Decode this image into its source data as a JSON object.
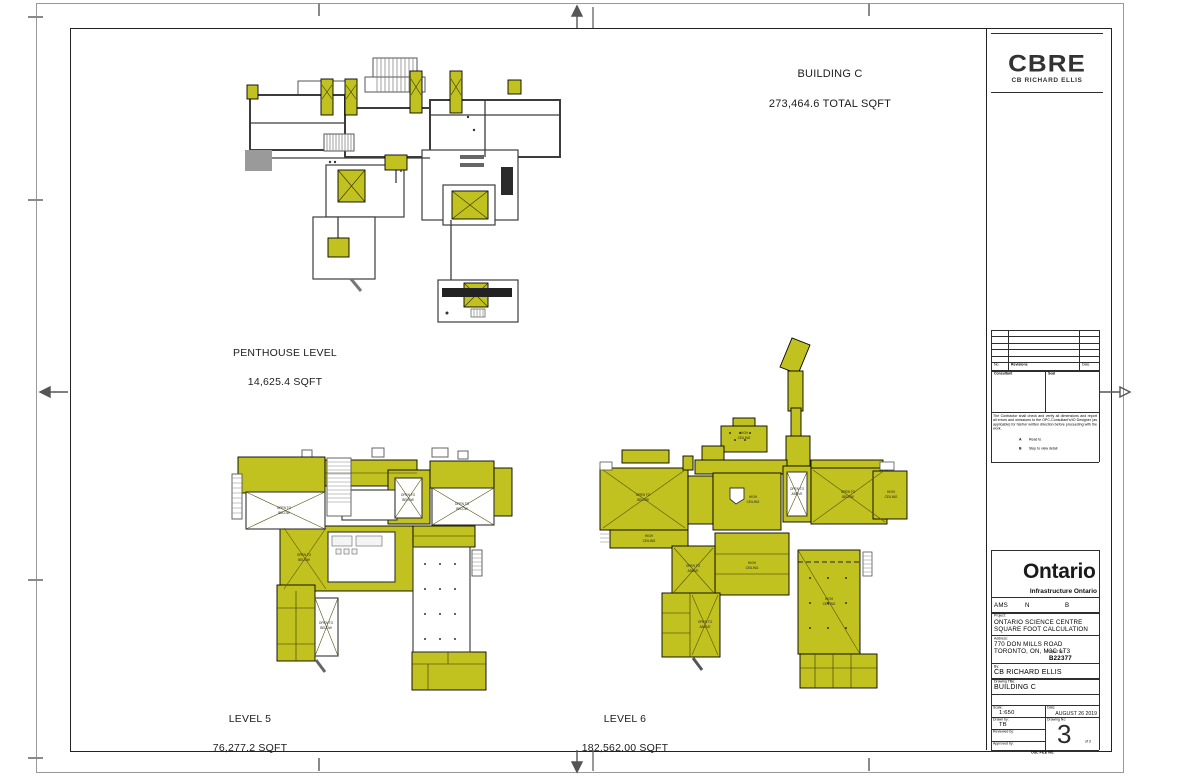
{
  "colors": {
    "plan_yellow": "#c1c11f",
    "wall": "#3c3c3c",
    "frame": "#222222"
  },
  "header": {
    "title": "BUILDING C",
    "subtitle": "273,464.6 TOTAL SQFT"
  },
  "plans": {
    "penthouse": {
      "name": "PENTHOUSE LEVEL",
      "area": "14,625.4 SQFT"
    },
    "level5": {
      "name": "LEVEL 5",
      "area": "76,277.2 SQFT"
    },
    "level6": {
      "name": "LEVEL 6",
      "area": "182,562.00 SQFT"
    },
    "annotations": {
      "open_to": "OPEN TO",
      "below": "BELOW",
      "above": "ABOVE",
      "high": "HIGH",
      "ceiling": "CEILING"
    }
  },
  "titleblock": {
    "cbre": "CBRE",
    "cbre_sub": "CB RICHARD ELLIS",
    "rev_no": "No.",
    "rev_desc": "Revisions",
    "rev_date": "Date",
    "consultant": "Consultant",
    "seal": "Seal",
    "note": "The Contractor shall check and verify all dimensions and report all errors and omissions to the OPC-Consultant's/IO Designer (as applicable) for his/her written direction before proceeding with the work.",
    "legend_a": "A",
    "legend_a_text": "Read to",
    "legend_b": "B",
    "legend_b_text": "Step to view detail",
    "ontario": "Ontario",
    "ontario_sub": "Infrastructure Ontario",
    "ams": "AMS",
    "ams_n": "N",
    "ams_b": "B",
    "project_label": "Project:",
    "project1": "ONTARIO SCIENCE CENTRE",
    "project2": "SQUARE FOOT CALCULATION",
    "address_label": "Address:",
    "address1": "770 DON MILLS ROAD",
    "address2": "TORONTO, ON, M3C 1T3",
    "project_no_label": "Project No:",
    "project_no": "B22377",
    "by_label": "By:",
    "by": "CB RICHARD ELLIS",
    "title_label": "Drawing Title:",
    "title": "BUILDING C",
    "scale_label": "Scale:",
    "scale": "1:650",
    "date_label": "Date:",
    "date": "AUGUST 26 2019",
    "drawn_label": "Drawn by:",
    "drawn": "TB",
    "reviewed_label": "Reviewed by:",
    "approved_label": "Approved by:",
    "dwg_label": "Drawing No:",
    "dwg_no": "3",
    "dwg_of": "of 3",
    "footer": "OSC FILE NO."
  }
}
